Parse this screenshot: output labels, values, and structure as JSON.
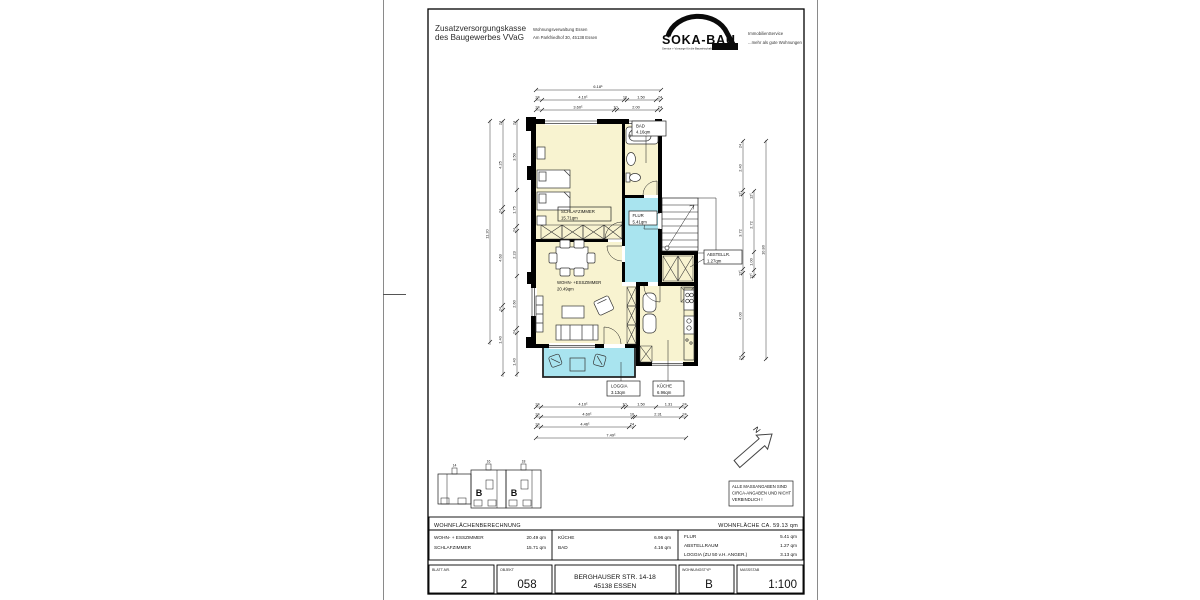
{
  "colors": {
    "room_fill": "#F8F3D0",
    "wet_fill": "#A9E4EF",
    "wall": "#000000"
  },
  "header": {
    "org_line1": "Zusatzversorgungskasse",
    "org_line2": "des Baugewerbes VVaG",
    "dept_line1": "Wohnungsverwaltung  Essen",
    "dept_line2": "Am Parkfriedhof 30, 45138 Essen",
    "logo": {
      "name": "SOKA-BAU",
      "tagline": "Service + Vorsorge für die Bauwirtschaft",
      "right_line1": "ImmobilienService",
      "right_line2": "...mehr als gute Wohnungen"
    }
  },
  "plan": {
    "rooms": {
      "schlafzimmer": {
        "label": "SCHLAFZIMMER",
        "area": "15.71qm"
      },
      "bad": {
        "label": "BAD",
        "area": "4.16qm"
      },
      "flur": {
        "label": "FLUR",
        "area": "5.41qm"
      },
      "wohn": {
        "label": "WOHN- +ESSZIMMER",
        "area": "20.49qm"
      },
      "abstellraum": {
        "label": "ABSTELLR.",
        "area": "1.27qm"
      },
      "kueche": {
        "label": "KÜCHE",
        "area": "6.96qm"
      },
      "loggia": {
        "label": "LOGGIA",
        "area": "3.13qm"
      }
    },
    "dims": {
      "top": {
        "total": "6.18⁵",
        "row2": [
          "24",
          "4.10⁵",
          "10",
          "1.50",
          "24"
        ],
        "row3": [
          "24",
          "3.60⁵",
          "10",
          "2.00",
          "24"
        ]
      },
      "bottom": {
        "row1": [
          "24",
          "4.10⁵",
          "10",
          "1.50",
          "1.31",
          "24"
        ],
        "row2": [
          "24",
          "4.60⁵",
          "10",
          "2.31",
          "24"
        ],
        "row3": [
          "24",
          "4.46⁵",
          "24"
        ],
        "total": "7.49⁵"
      },
      "left": {
        "total": "11.20",
        "mid": [
          "24",
          "4.25",
          "24",
          "4.63",
          "24",
          "1.40"
        ],
        "inner": [
          "24",
          "3.50",
          "1.75",
          "24",
          "2.23",
          "2.60",
          "24",
          "1.40"
        ]
      },
      "right": {
        "total": "10.80",
        "colA": [
          "24",
          "2.40",
          "12⁵",
          "3.72",
          "12⁵",
          "4.00",
          "24"
        ],
        "colB": [
          "12⁵",
          "2.72",
          "1.00",
          "12⁵"
        ]
      }
    },
    "north_label": "N",
    "keyplan": {
      "letters": [
        "B",
        "B"
      ],
      "numbers": [
        "14",
        "16",
        "18"
      ]
    }
  },
  "note": {
    "line1": "ALLE MASSANGABEN SIND",
    "line2": "CIRCA-ANGABEN UND NICHT",
    "line3": "VERBINDLICH !"
  },
  "area_table": {
    "title": "WOHNFLÄCHENBERECHNUNG",
    "total_label": "WOHNFLÄCHE  CA.  59.13 qm",
    "col1": [
      {
        "label": "WOHN- + ESSZIMMER",
        "value": "20.49 qm"
      },
      {
        "label": "SCHLAFZIMMER",
        "value": "15.71 qm"
      }
    ],
    "col2": [
      {
        "label": "KÜCHE",
        "value": "6.96 qm"
      },
      {
        "label": "BAD",
        "value": "4.16 qm"
      }
    ],
    "col3": [
      {
        "label": "FLUR",
        "value": "5.41 qm"
      },
      {
        "label": "ABSTELLRAUM",
        "value": "1.27 qm"
      },
      {
        "label": "LOGGIA (ZU 50 v.H. ANGER.)",
        "value": "3.13 qm"
      }
    ]
  },
  "footer": {
    "blatt": {
      "label": "BLATT-NR.",
      "value": "2"
    },
    "objekt": {
      "label": "OBJEKT",
      "value": "058"
    },
    "address_line1": "BERGHAUSER STR. 14-18",
    "address_line2": "45138 ESSEN",
    "typ": {
      "label": "WOHNUNGSTYP",
      "value": "B"
    },
    "massstab": {
      "label": "MASSSTAB",
      "value": "1:100"
    }
  }
}
